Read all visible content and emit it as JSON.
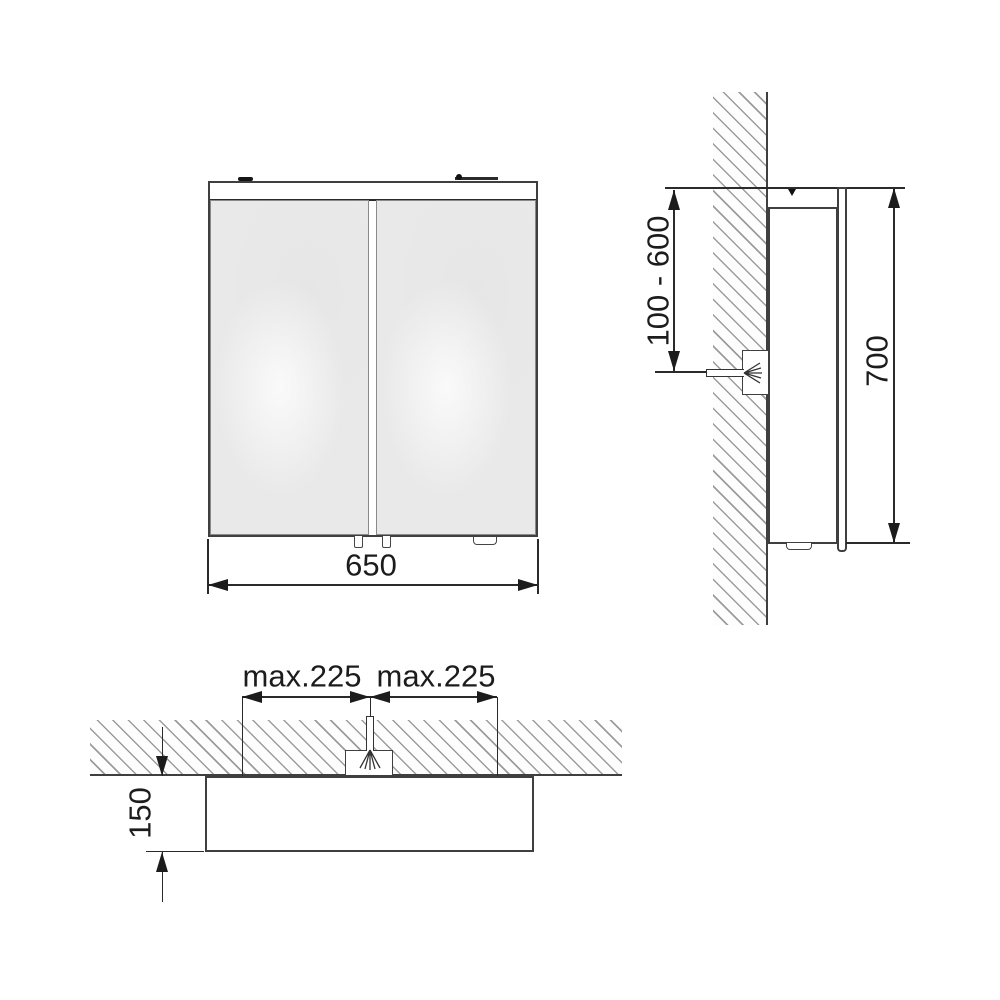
{
  "labels": {
    "front_width": "650",
    "side_height": "700",
    "outlet_height_range": "100 - 600",
    "spacing_left": "max.225",
    "spacing_right": "max.225",
    "wall_offset": "150"
  },
  "colors": {
    "outline": "#3f3f3f",
    "dimension": "#1c1c1c",
    "mirror_fill": "#e9e9e9",
    "hatch_stroke": "#9c9c9c",
    "background": "#ffffff"
  }
}
